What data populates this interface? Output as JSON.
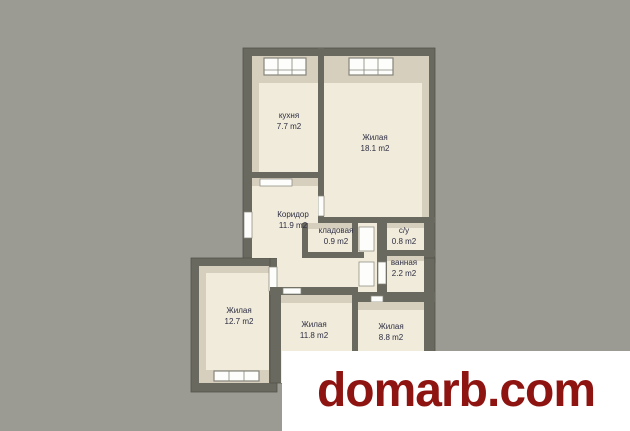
{
  "scene": {
    "type": "apartment floor plan image",
    "background_color": "#9b9b94"
  },
  "floor_plan": {
    "rooms": [
      {
        "name": "кухня",
        "area": "7.7 m2"
      },
      {
        "name": "Жилая",
        "area": "18.1 m2"
      },
      {
        "name": "Коридор",
        "area": "11.9 m2"
      },
      {
        "name": "кладовая",
        "area": "0.9 m2"
      },
      {
        "name": "c/y",
        "area": "0.8 m2"
      },
      {
        "name": "ванная",
        "area": "2.2 m2"
      },
      {
        "name": "Жилая",
        "area": "12.7 m2"
      },
      {
        "name": "Жилая",
        "area": "11.8 m2"
      },
      {
        "name": "Жилая",
        "area": "8.8 m2"
      }
    ]
  },
  "watermark": {
    "text": "domarb.com"
  },
  "colors": {
    "background": "#9b9b94",
    "wall": "#69695f",
    "wall_edge": "#54544b",
    "floor": "#f0ebdb",
    "band": "#d7cfbe",
    "window": "#fdfdfc",
    "frame": "#85857b",
    "label_text": "#2d2d42",
    "watermark_text": "#8e1411",
    "watermark_bg": "#ffffff"
  }
}
